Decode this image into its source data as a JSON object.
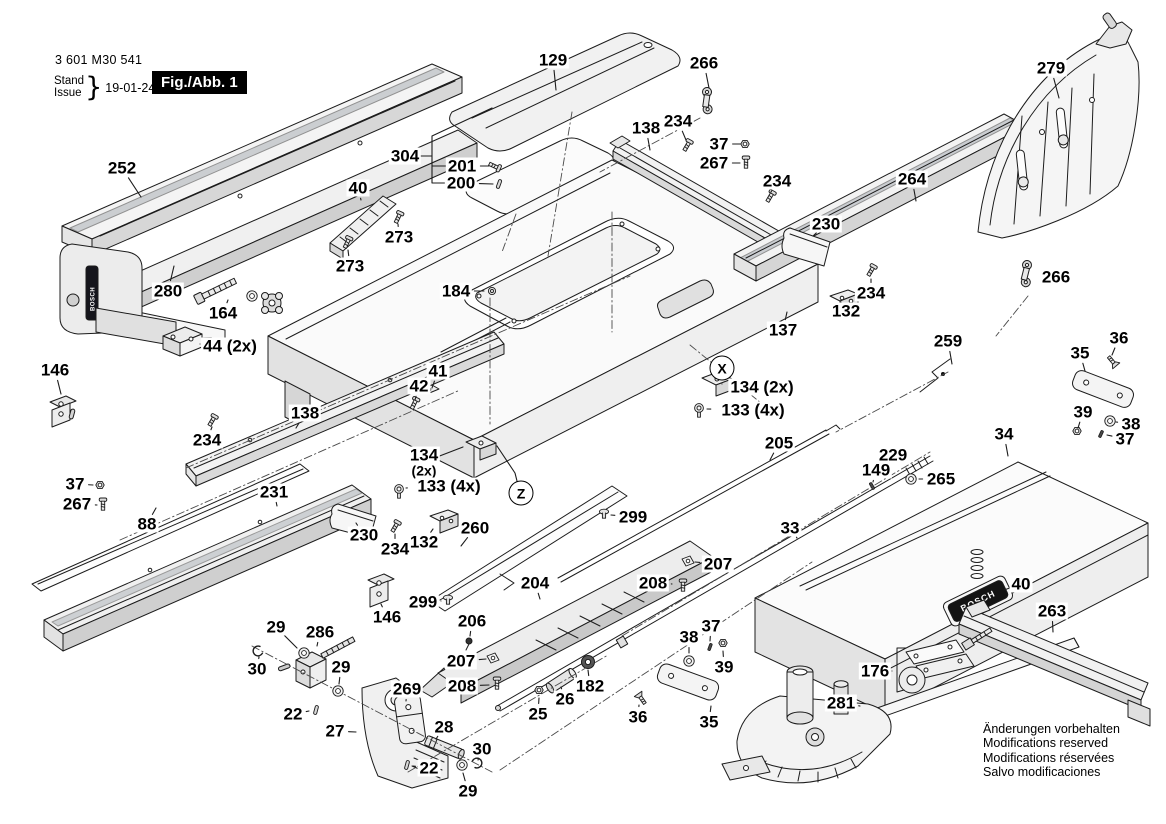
{
  "header": {
    "part_number": "3 601 M30 541",
    "stand_label": "Stand",
    "issue_label": "Issue",
    "brace": "}",
    "date": "19-01-24",
    "figure_label": "Fig./Abb. 1"
  },
  "footer": {
    "notes": [
      "Änderungen vorbehalten",
      "Modifications reserved",
      "Modifications réservées",
      "Salvo modificaciones"
    ]
  },
  "brand": {
    "logo_text": "BOSCH",
    "badge_bg": "#141414",
    "line_color": "#1c1c1c",
    "paper_color": "#ffffff"
  },
  "markers": [
    {
      "label": "X",
      "x": 722,
      "y": 368
    },
    {
      "label": "Z",
      "x": 521,
      "y": 493
    }
  ],
  "callouts": [
    {
      "label": "252",
      "x": 122,
      "y": 168,
      "lx": 141,
      "ly": 197
    },
    {
      "label": "129",
      "x": 553,
      "y": 60,
      "lx": 556,
      "ly": 90
    },
    {
      "label": "266",
      "x": 704,
      "y": 63,
      "lx": 709,
      "ly": 88
    },
    {
      "label": "279",
      "x": 1051,
      "y": 68,
      "lx": 1059,
      "ly": 98
    },
    {
      "label": "138",
      "x": 646,
      "y": 128,
      "lx": 650,
      "ly": 150
    },
    {
      "label": "234",
      "x": 678,
      "y": 121,
      "lx": 686,
      "ly": 140
    },
    {
      "label": "37",
      "x": 719,
      "y": 144,
      "lx": 740,
      "ly": 144
    },
    {
      "label": "267",
      "x": 714,
      "y": 163,
      "lx": 740,
      "ly": 163
    },
    {
      "label": "234",
      "x": 777,
      "y": 181,
      "lx": 771,
      "ly": 192
    },
    {
      "label": "264",
      "x": 912,
      "y": 179,
      "lx": 916,
      "ly": 201
    },
    {
      "label": "304",
      "x": 405,
      "y": 156,
      "lx": 420,
      "ly": 156
    },
    {
      "label": "201",
      "x": 462,
      "y": 166,
      "lx": 489,
      "ly": 166
    },
    {
      "label": "200",
      "x": 461,
      "y": 183,
      "lx": 493,
      "ly": 184
    },
    {
      "label": "40",
      "x": 358,
      "y": 188,
      "lx": 361,
      "ly": 200
    },
    {
      "label": "273",
      "x": 399,
      "y": 237,
      "lx": 398,
      "ly": 224
    },
    {
      "label": "273",
      "x": 350,
      "y": 266,
      "lx": 348,
      "ly": 250
    },
    {
      "label": "230",
      "x": 826,
      "y": 224,
      "lx": 813,
      "ly": 236
    },
    {
      "label": "280",
      "x": 168,
      "y": 291,
      "lx": 174,
      "ly": 266
    },
    {
      "label": "164",
      "x": 223,
      "y": 313,
      "lx": 228,
      "ly": 300
    },
    {
      "label": "44 (2x)",
      "x": 230,
      "y": 346,
      "lx": 200,
      "ly": 344
    },
    {
      "label": "234",
      "x": 871,
      "y": 293,
      "lx": 871,
      "ly": 279
    },
    {
      "label": "132",
      "x": 846,
      "y": 311,
      "lx": 841,
      "ly": 302
    },
    {
      "label": "184",
      "x": 456,
      "y": 291,
      "lx": 484,
      "ly": 291
    },
    {
      "label": "137",
      "x": 783,
      "y": 330,
      "lx": 787,
      "ly": 312
    },
    {
      "label": "134 (2x)",
      "x": 762,
      "y": 387,
      "lx": 722,
      "ly": 384
    },
    {
      "label": "133 (4x)",
      "x": 753,
      "y": 410,
      "lx": 707,
      "ly": 409
    },
    {
      "label": "259",
      "x": 948,
      "y": 341,
      "lx": 952,
      "ly": 364
    },
    {
      "label": "36",
      "x": 1119,
      "y": 338,
      "lx": 1112,
      "ly": 355
    },
    {
      "label": "35",
      "x": 1080,
      "y": 353,
      "lx": 1085,
      "ly": 371
    },
    {
      "label": "41",
      "x": 438,
      "y": 371,
      "lx": 432,
      "ly": 388
    },
    {
      "label": "42",
      "x": 419,
      "y": 386,
      "lx": 415,
      "ly": 400
    },
    {
      "label": "146",
      "x": 55,
      "y": 370,
      "lx": 61,
      "ly": 394
    },
    {
      "label": "138",
      "x": 305,
      "y": 413,
      "lx": 296,
      "ly": 428
    },
    {
      "label": "234",
      "x": 207,
      "y": 440,
      "lx": 212,
      "ly": 427
    },
    {
      "label": "231",
      "x": 274,
      "y": 492,
      "lx": 277,
      "ly": 506
    },
    {
      "label": "37",
      "x": 75,
      "y": 484,
      "lx": 93,
      "ly": 485
    },
    {
      "label": "267",
      "x": 77,
      "y": 504,
      "lx": 97,
      "ly": 505
    },
    {
      "label": "88",
      "x": 147,
      "y": 524,
      "lx": 156,
      "ly": 508
    },
    {
      "label": "134",
      "label2": "(2x)",
      "x": 424,
      "y": 462,
      "lx": 463,
      "ly": 447
    },
    {
      "label": "133 (4x)",
      "x": 449,
      "y": 486,
      "lx": 406,
      "ly": 488
    },
    {
      "label": "229",
      "x": 893,
      "y": 455,
      "lx": 889,
      "ly": 466
    },
    {
      "label": "149",
      "x": 876,
      "y": 470,
      "lx": 873,
      "ly": 482
    },
    {
      "label": "265",
      "x": 941,
      "y": 479,
      "lx": 919,
      "ly": 479
    },
    {
      "label": "34",
      "x": 1004,
      "y": 434,
      "lx": 1008,
      "ly": 456
    },
    {
      "label": "39",
      "x": 1083,
      "y": 412,
      "lx": 1078,
      "ly": 428
    },
    {
      "label": "38",
      "x": 1131,
      "y": 424,
      "lx": 1116,
      "ly": 422
    },
    {
      "label": "37",
      "x": 1125,
      "y": 439,
      "lx": 1107,
      "ly": 435
    },
    {
      "label": "205",
      "x": 779,
      "y": 443,
      "lx": 770,
      "ly": 460
    },
    {
      "label": "33",
      "x": 790,
      "y": 528,
      "lx": 797,
      "ly": 538
    },
    {
      "label": "299",
      "x": 633,
      "y": 517,
      "lx": 611,
      "ly": 515
    },
    {
      "label": "260",
      "x": 475,
      "y": 528,
      "lx": 461,
      "ly": 546
    },
    {
      "label": "230",
      "x": 364,
      "y": 535,
      "lx": 356,
      "ly": 523
    },
    {
      "label": "234",
      "x": 395,
      "y": 549,
      "lx": 395,
      "ly": 534
    },
    {
      "label": "132",
      "x": 424,
      "y": 542,
      "lx": 433,
      "ly": 529
    },
    {
      "label": "299",
      "x": 423,
      "y": 602,
      "lx": 441,
      "ly": 601
    },
    {
      "label": "146",
      "x": 387,
      "y": 617,
      "lx": 381,
      "ly": 604
    },
    {
      "label": "204",
      "x": 535,
      "y": 583,
      "lx": 540,
      "ly": 599
    },
    {
      "label": "206",
      "x": 472,
      "y": 621,
      "lx": 470,
      "ly": 636
    },
    {
      "label": "207",
      "x": 461,
      "y": 661,
      "lx": 486,
      "ly": 659
    },
    {
      "label": "208",
      "x": 462,
      "y": 686,
      "lx": 489,
      "ly": 685
    },
    {
      "label": "207",
      "x": 718,
      "y": 564,
      "lx": 695,
      "ly": 562
    },
    {
      "label": "208",
      "x": 653,
      "y": 583,
      "lx": 672,
      "ly": 584
    },
    {
      "label": "29",
      "x": 276,
      "y": 627,
      "lx": 297,
      "ly": 648
    },
    {
      "label": "286",
      "x": 320,
      "y": 632,
      "lx": 317,
      "ly": 646
    },
    {
      "label": "30",
      "x": 257,
      "y": 669,
      "lx": 259,
      "ly": 657
    },
    {
      "label": "29",
      "x": 341,
      "y": 667,
      "lx": 339,
      "ly": 684
    },
    {
      "label": "22",
      "x": 293,
      "y": 714,
      "lx": 309,
      "ly": 711
    },
    {
      "label": "27",
      "x": 335,
      "y": 731,
      "lx": 356,
      "ly": 732
    },
    {
      "label": "269",
      "x": 407,
      "y": 689,
      "lx": 406,
      "ly": 701
    },
    {
      "label": "28",
      "x": 444,
      "y": 727,
      "lx": 436,
      "ly": 739
    },
    {
      "label": "30",
      "x": 482,
      "y": 749,
      "lx": 478,
      "ly": 760
    },
    {
      "label": "22",
      "x": 429,
      "y": 768,
      "lx": 413,
      "ly": 766
    },
    {
      "label": "29",
      "x": 468,
      "y": 791,
      "lx": 463,
      "ly": 773
    },
    {
      "label": "25",
      "x": 538,
      "y": 714,
      "lx": 539,
      "ly": 698
    },
    {
      "label": "26",
      "x": 565,
      "y": 699,
      "lx": 561,
      "ly": 687
    },
    {
      "label": "182",
      "x": 590,
      "y": 686,
      "lx": 588,
      "ly": 670
    },
    {
      "label": "36",
      "x": 638,
      "y": 717,
      "lx": 639,
      "ly": 705
    },
    {
      "label": "35",
      "x": 709,
      "y": 722,
      "lx": 711,
      "ly": 706
    },
    {
      "label": "38",
      "x": 689,
      "y": 637,
      "lx": 689,
      "ly": 653
    },
    {
      "label": "37",
      "x": 711,
      "y": 626,
      "lx": 710,
      "ly": 641
    },
    {
      "label": "39",
      "x": 724,
      "y": 667,
      "lx": 723,
      "ly": 651
    },
    {
      "label": "176",
      "x": 875,
      "y": 671,
      "lx": 892,
      "ly": 671
    },
    {
      "label": "281",
      "x": 841,
      "y": 703,
      "lx": 860,
      "ly": 706
    },
    {
      "label": "263",
      "x": 1052,
      "y": 611,
      "lx": 1053,
      "ly": 632
    },
    {
      "label": "40",
      "x": 1021,
      "y": 584,
      "lx": 1004,
      "ly": 590
    },
    {
      "label": "266",
      "x": 1056,
      "y": 277,
      "lx": 1041,
      "ly": 277
    }
  ]
}
